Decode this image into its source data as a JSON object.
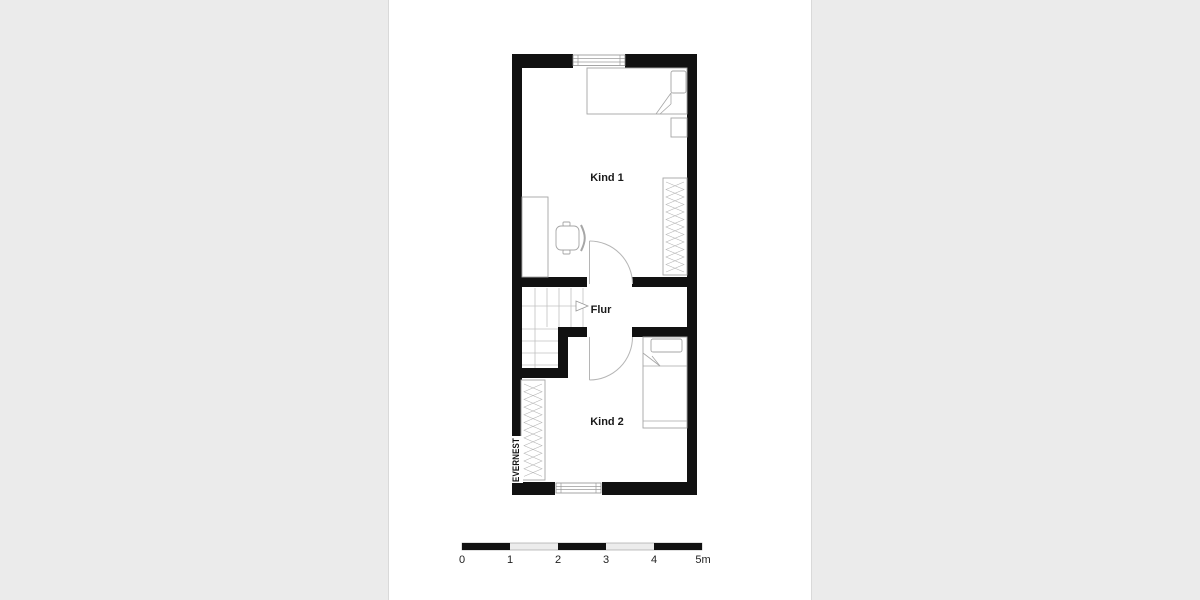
{
  "app": {
    "background_color": "#ebebeb",
    "paper_color": "#ffffff"
  },
  "floorplan": {
    "watermark": "EVERNEST",
    "rooms": [
      {
        "name": "Kind 1"
      },
      {
        "name": "Flur"
      },
      {
        "name": "Kind 2"
      }
    ],
    "features": {
      "kind1": [
        "bed",
        "pillow",
        "nightstand",
        "wardrobe",
        "desk",
        "chair",
        "door",
        "window-top"
      ],
      "flur": [
        "staircase-upper-flight",
        "staircase-lower-flight",
        "walk-line-arrow"
      ],
      "kind2": [
        "bed",
        "pillow",
        "wardrobe",
        "door",
        "window-bottom"
      ]
    },
    "colors": {
      "wall": "#111111",
      "furniture_line": "#a6a6a6",
      "door_swing": "#b5b5b5",
      "stair_line": "#c0c0c0"
    }
  },
  "scale_bar": {
    "unit": "m",
    "labels": [
      "0",
      "1",
      "2",
      "3",
      "4",
      "5m"
    ]
  }
}
